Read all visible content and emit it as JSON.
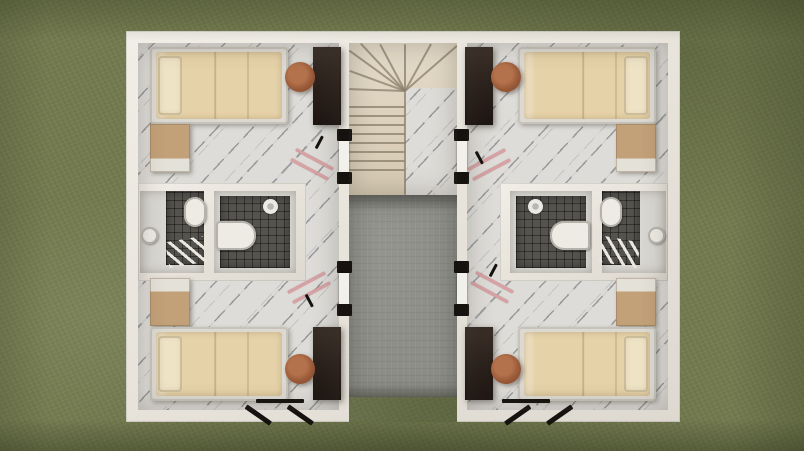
{
  "scene": {
    "kind": "3d-floorplan-top-view-render",
    "description": "Top-down 3D architectural render of a mirrored duplex upper floor on a grass lawn: four bedrooms with single beds, desks, chairs and dressers, four dark-tiled bathrooms with toilets, sinks and showers, a central cream winder staircase, and a grey concrete central courtyard strip open to the lawn.",
    "canvas": {
      "width": 804,
      "height": 451
    },
    "elements": [
      {
        "name": "grass-lawn",
        "type": "grass",
        "x": 0,
        "y": 0,
        "w": 804,
        "h": 451
      },
      {
        "name": "building-shell",
        "type": "wall building",
        "x": 126,
        "y": 31,
        "w": 554,
        "h": 391
      },
      {
        "name": "unit-left-floor",
        "type": "marble",
        "x": 138,
        "y": 43,
        "w": 201,
        "h": 367
      },
      {
        "name": "unit-right-floor",
        "type": "marble",
        "x": 467,
        "y": 43,
        "w": 201,
        "h": 367
      },
      {
        "name": "stairwell-floor",
        "type": "stairs",
        "x": 349,
        "y": 43,
        "w": 108,
        "h": 152
      },
      {
        "name": "stair-landing",
        "type": "marble",
        "x": 405,
        "y": 88,
        "w": 52,
        "h": 107
      },
      {
        "name": "courtyard-concrete",
        "type": "concrete",
        "x": 349,
        "y": 195,
        "w": 108,
        "h": 202
      },
      {
        "name": "courtyard-grass-gap",
        "type": "grass",
        "x": 349,
        "y": 397,
        "w": 108,
        "h": 25
      },
      {
        "name": "courtyard-top-shadow",
        "type": "shade-down",
        "x": 349,
        "y": 195,
        "w": 108,
        "h": 16
      },
      {
        "name": "courtyard-edge-shadow",
        "type": "shade-up",
        "x": 349,
        "y": 385,
        "w": 108,
        "h": 12
      },
      {
        "name": "stair-tread",
        "type": "stair-line",
        "x": 349,
        "y": 106,
        "w": 56,
        "h": 2
      },
      {
        "name": "stair-tread",
        "type": "stair-line",
        "x": 349,
        "y": 115,
        "w": 56,
        "h": 2
      },
      {
        "name": "stair-tread",
        "type": "stair-line",
        "x": 349,
        "y": 124,
        "w": 56,
        "h": 2
      },
      {
        "name": "stair-tread",
        "type": "stair-line",
        "x": 349,
        "y": 133,
        "w": 56,
        "h": 2
      },
      {
        "name": "stair-tread",
        "type": "stair-line",
        "x": 349,
        "y": 142,
        "w": 56,
        "h": 2
      },
      {
        "name": "stair-tread",
        "type": "stair-line",
        "x": 349,
        "y": 151,
        "w": 56,
        "h": 2
      },
      {
        "name": "stair-tread",
        "type": "stair-line",
        "x": 349,
        "y": 160,
        "w": 56,
        "h": 2
      },
      {
        "name": "stair-tread",
        "type": "stair-line",
        "x": 349,
        "y": 169,
        "w": 56,
        "h": 2
      },
      {
        "name": "stair-winder-edge",
        "type": "stair-line",
        "x": 405,
        "y": 90,
        "w": 56,
        "h": 2,
        "rotate": -178
      },
      {
        "name": "stair-winder-edge",
        "type": "stair-line",
        "x": 405,
        "y": 90,
        "w": 59,
        "h": 2,
        "rotate": -160
      },
      {
        "name": "stair-winder-edge",
        "type": "stair-line",
        "x": 405,
        "y": 90,
        "w": 69,
        "h": 2,
        "rotate": -144
      },
      {
        "name": "stair-winder-edge",
        "type": "stair-line",
        "x": 405,
        "y": 90,
        "w": 65,
        "h": 2,
        "rotate": -133
      },
      {
        "name": "stair-winder-edge",
        "type": "stair-line",
        "x": 405,
        "y": 90,
        "w": 53,
        "h": 2,
        "rotate": -118
      },
      {
        "name": "stair-winder-edge",
        "type": "stair-line",
        "x": 405,
        "y": 90,
        "w": 47,
        "h": 2,
        "rotate": -90
      },
      {
        "name": "stair-winder-edge",
        "type": "stair-line",
        "x": 405,
        "y": 90,
        "w": 54,
        "h": 2,
        "rotate": -61
      },
      {
        "name": "stair-winder-edge",
        "type": "stair-line",
        "x": 405,
        "y": 90,
        "w": 69,
        "h": 2,
        "rotate": -41
      },
      {
        "name": "stair-stringer",
        "type": "stair-line",
        "x": 404,
        "y": 90,
        "w": 2,
        "h": 105
      },
      {
        "name": "stairwell-door-frame",
        "type": "black",
        "x": 337,
        "y": 129,
        "w": 15,
        "h": 12
      },
      {
        "name": "stairwell-door-leaf",
        "type": "door-leaf",
        "x": 339,
        "y": 141,
        "w": 10,
        "h": 31
      },
      {
        "name": "stairwell-door-frame",
        "type": "black",
        "x": 337,
        "y": 172,
        "w": 15,
        "h": 12
      },
      {
        "name": "stairwell-door-frame",
        "type": "black",
        "x": 337,
        "y": 261,
        "w": 15,
        "h": 12
      },
      {
        "name": "stairwell-door-leaf",
        "type": "door-leaf",
        "x": 339,
        "y": 273,
        "w": 10,
        "h": 31
      },
      {
        "name": "stairwell-door-frame",
        "type": "black",
        "x": 337,
        "y": 304,
        "w": 15,
        "h": 12
      },
      {
        "name": "stairwell-door-frame",
        "type": "black",
        "x": 454,
        "y": 129,
        "w": 15,
        "h": 12
      },
      {
        "name": "stairwell-door-leaf",
        "type": "door-leaf",
        "x": 457,
        "y": 141,
        "w": 10,
        "h": 31
      },
      {
        "name": "stairwell-door-frame",
        "type": "black",
        "x": 454,
        "y": 172,
        "w": 15,
        "h": 12
      },
      {
        "name": "stairwell-door-frame",
        "type": "black",
        "x": 454,
        "y": 261,
        "w": 15,
        "h": 12
      },
      {
        "name": "stairwell-door-leaf",
        "type": "door-leaf",
        "x": 457,
        "y": 273,
        "w": 10,
        "h": 31
      },
      {
        "name": "stairwell-door-frame",
        "type": "black",
        "x": 454,
        "y": 304,
        "w": 15,
        "h": 12
      },
      {
        "name": "bathroom-block-walls",
        "type": "wall",
        "x": 138,
        "y": 183,
        "w": 168,
        "h": 98
      },
      {
        "name": "bathroom-outer-floor",
        "type": "bathfloor",
        "x": 140,
        "y": 191,
        "w": 64,
        "h": 82
      },
      {
        "name": "bathroom-inner-floor",
        "type": "bathfloor",
        "x": 214,
        "y": 191,
        "w": 82,
        "h": 82
      },
      {
        "name": "shower-tile",
        "type": "tile",
        "x": 166,
        "y": 191,
        "w": 38,
        "h": 74
      },
      {
        "name": "shower-tile",
        "type": "tile",
        "x": 220,
        "y": 196,
        "w": 70,
        "h": 72
      },
      {
        "name": "toilet",
        "type": "fixture",
        "x": 184,
        "y": 197,
        "w": 22,
        "h": 30,
        "radius": "11px"
      },
      {
        "name": "sink",
        "type": "fixture",
        "x": 141,
        "y": 227,
        "w": 17,
        "h": 17,
        "radius": "50%"
      },
      {
        "name": "drying-ladder",
        "type": "ladder",
        "x": 167,
        "y": 239,
        "w": 38,
        "h": 26,
        "rotate": -10,
        "origin": "50% 50%"
      },
      {
        "name": "toilet",
        "type": "fixture",
        "x": 216,
        "y": 221,
        "w": 40,
        "h": 29,
        "radius": "4px 14px 14px 4px"
      },
      {
        "name": "shower-head",
        "type": "shower",
        "x": 263,
        "y": 199,
        "w": 15,
        "h": 15
      },
      {
        "name": "bathroom-block-walls",
        "type": "wall",
        "x": 500,
        "y": 183,
        "w": 168,
        "h": 98
      },
      {
        "name": "bathroom-outer-floor",
        "type": "bathfloor",
        "x": 602,
        "y": 191,
        "w": 64,
        "h": 82
      },
      {
        "name": "bathroom-inner-floor",
        "type": "bathfloor",
        "x": 510,
        "y": 191,
        "w": 82,
        "h": 82
      },
      {
        "name": "shower-tile",
        "type": "tile",
        "x": 602,
        "y": 191,
        "w": 38,
        "h": 74
      },
      {
        "name": "shower-tile",
        "type": "tile",
        "x": 516,
        "y": 196,
        "w": 70,
        "h": 72
      },
      {
        "name": "toilet",
        "type": "fixture",
        "x": 600,
        "y": 197,
        "w": 22,
        "h": 30,
        "radius": "11px"
      },
      {
        "name": "sink",
        "type": "fixture",
        "x": 648,
        "y": 227,
        "w": 17,
        "h": 17,
        "radius": "50%"
      },
      {
        "name": "drying-ladder",
        "type": "ladder",
        "x": 601,
        "y": 239,
        "w": 38,
        "h": 26,
        "rotate": 10,
        "origin": "50% 50%"
      },
      {
        "name": "toilet",
        "type": "fixture",
        "x": 550,
        "y": 221,
        "w": 40,
        "h": 29,
        "radius": "14px 4px 4px 14px"
      },
      {
        "name": "shower-head",
        "type": "shower",
        "x": 528,
        "y": 199,
        "w": 15,
        "h": 15
      },
      {
        "name": "bed",
        "type": "bedframe",
        "x": 150,
        "y": 47,
        "w": 138,
        "h": 77
      },
      {
        "name": "bed-mattress",
        "type": "mattress",
        "x": 156,
        "y": 52,
        "w": 126,
        "h": 67
      },
      {
        "name": "bed-pillow",
        "type": "pillow",
        "x": 158,
        "y": 56,
        "w": 24,
        "h": 59
      },
      {
        "name": "desk",
        "type": "wood",
        "x": 313,
        "y": 47,
        "w": 28,
        "h": 78
      },
      {
        "name": "chair",
        "type": "chair",
        "x": 285,
        "y": 62,
        "w": 30,
        "h": 30
      },
      {
        "name": "dresser",
        "type": "dresser-a",
        "x": 150,
        "y": 124,
        "w": 40,
        "h": 48
      },
      {
        "name": "dresser",
        "type": "dresser-b",
        "x": 150,
        "y": 278,
        "w": 40,
        "h": 48
      },
      {
        "name": "bed",
        "type": "bedframe",
        "x": 150,
        "y": 327,
        "w": 138,
        "h": 74
      },
      {
        "name": "bed-mattress",
        "type": "mattress",
        "x": 156,
        "y": 332,
        "w": 126,
        "h": 64
      },
      {
        "name": "bed-pillow",
        "type": "pillow",
        "x": 158,
        "y": 336,
        "w": 24,
        "h": 56
      },
      {
        "name": "desk",
        "type": "wood",
        "x": 313,
        "y": 327,
        "w": 28,
        "h": 73
      },
      {
        "name": "chair",
        "type": "chair",
        "x": 285,
        "y": 354,
        "w": 30,
        "h": 30
      },
      {
        "name": "bed",
        "type": "bedframe",
        "x": 518,
        "y": 47,
        "w": 138,
        "h": 77
      },
      {
        "name": "bed-mattress",
        "type": "mattress",
        "x": 524,
        "y": 52,
        "w": 126,
        "h": 67
      },
      {
        "name": "bed-pillow",
        "type": "pillow",
        "x": 624,
        "y": 56,
        "w": 24,
        "h": 59
      },
      {
        "name": "desk",
        "type": "wood",
        "x": 465,
        "y": 47,
        "w": 28,
        "h": 78
      },
      {
        "name": "chair",
        "type": "chair",
        "x": 491,
        "y": 62,
        "w": 30,
        "h": 30
      },
      {
        "name": "dresser",
        "type": "dresser-a",
        "x": 616,
        "y": 124,
        "w": 40,
        "h": 48
      },
      {
        "name": "dresser",
        "type": "dresser-b",
        "x": 616,
        "y": 278,
        "w": 40,
        "h": 48
      },
      {
        "name": "bed",
        "type": "bedframe",
        "x": 518,
        "y": 327,
        "w": 138,
        "h": 74
      },
      {
        "name": "bed-mattress",
        "type": "mattress",
        "x": 524,
        "y": 332,
        "w": 126,
        "h": 64
      },
      {
        "name": "bed-pillow",
        "type": "pillow",
        "x": 624,
        "y": 336,
        "w": 24,
        "h": 56
      },
      {
        "name": "desk",
        "type": "wood",
        "x": 465,
        "y": 327,
        "w": 28,
        "h": 73
      },
      {
        "name": "chair",
        "type": "chair",
        "x": 491,
        "y": 354,
        "w": 30,
        "h": 30
      },
      {
        "name": "drying-rack-bar",
        "type": "pinkline",
        "x": 296,
        "y": 148,
        "w": 42,
        "h": 3,
        "rotate": 28
      },
      {
        "name": "drying-rack-bar",
        "type": "pinkline",
        "x": 291,
        "y": 158,
        "w": 42,
        "h": 3,
        "rotate": 28
      },
      {
        "name": "drying-rack-bar",
        "type": "black",
        "x": 316,
        "y": 147,
        "w": 14,
        "h": 3,
        "rotate": -62
      },
      {
        "name": "drying-rack-bar",
        "type": "pinkline",
        "x": 288,
        "y": 291,
        "w": 42,
        "h": 3,
        "rotate": -28
      },
      {
        "name": "drying-rack-bar",
        "type": "pinkline",
        "x": 293,
        "y": 301,
        "w": 42,
        "h": 3,
        "rotate": -28
      },
      {
        "name": "drying-rack-bar",
        "type": "black",
        "x": 306,
        "y": 293,
        "w": 14,
        "h": 3,
        "rotate": 62
      },
      {
        "name": "drying-rack-bar",
        "type": "pinkline",
        "x": 468,
        "y": 168,
        "w": 42,
        "h": 3,
        "rotate": -28
      },
      {
        "name": "drying-rack-bar",
        "type": "pinkline",
        "x": 473,
        "y": 178,
        "w": 42,
        "h": 3,
        "rotate": -28
      },
      {
        "name": "drying-rack-bar",
        "type": "black",
        "x": 476,
        "y": 150,
        "w": 14,
        "h": 3,
        "rotate": 62
      },
      {
        "name": "drying-rack-bar",
        "type": "pinkline",
        "x": 476,
        "y": 271,
        "w": 42,
        "h": 3,
        "rotate": 28
      },
      {
        "name": "drying-rack-bar",
        "type": "pinkline",
        "x": 471,
        "y": 281,
        "w": 42,
        "h": 3,
        "rotate": 28
      },
      {
        "name": "drying-rack-bar",
        "type": "black",
        "x": 490,
        "y": 275,
        "w": 14,
        "h": 3,
        "rotate": -62
      },
      {
        "name": "window-frame",
        "type": "black",
        "x": 256,
        "y": 399,
        "w": 48,
        "h": 4
      },
      {
        "name": "window-sash",
        "type": "black",
        "x": 246,
        "y": 404,
        "w": 30,
        "h": 5,
        "rotate": 35
      },
      {
        "name": "window-sash",
        "type": "black",
        "x": 288,
        "y": 404,
        "w": 30,
        "h": 5,
        "rotate": 35
      },
      {
        "name": "window-frame",
        "type": "black",
        "x": 502,
        "y": 399,
        "w": 48,
        "h": 4
      },
      {
        "name": "window-sash",
        "type": "black",
        "x": 530,
        "y": 404,
        "w": 30,
        "h": 5,
        "rotate": 145
      },
      {
        "name": "window-sash",
        "type": "black",
        "x": 572,
        "y": 404,
        "w": 30,
        "h": 5,
        "rotate": 145
      },
      {
        "name": "floor-shading",
        "type": "ao",
        "x": 138,
        "y": 43,
        "w": 201,
        "h": 367
      },
      {
        "name": "floor-shading",
        "type": "ao",
        "x": 467,
        "y": 43,
        "w": 201,
        "h": 367
      },
      {
        "name": "stairwell-shading",
        "type": "ao",
        "x": 349,
        "y": 43,
        "w": 108,
        "h": 152
      },
      {
        "name": "scene-vignette",
        "type": "vignette",
        "x": 0,
        "y": 0,
        "w": 804,
        "h": 451
      }
    ]
  },
  "palette": {
    "grass": "#747b50",
    "marble": "#dedcd8",
    "tile": "#55534e",
    "concrete": "#8d8e88",
    "stair": "#ddd3c0",
    "stairline": "#8a7f69",
    "wall": "#ebe8e0",
    "wood": "#2a211c",
    "chair": "#9a5a38",
    "dresser": "#c2a078",
    "mattress": "#e6d2a8",
    "pillow": "#efe3c6",
    "fixture": "#edebe4",
    "bathfloor": "#d9d7d1",
    "pink": "#d8a1a4",
    "black": "#15120f"
  }
}
